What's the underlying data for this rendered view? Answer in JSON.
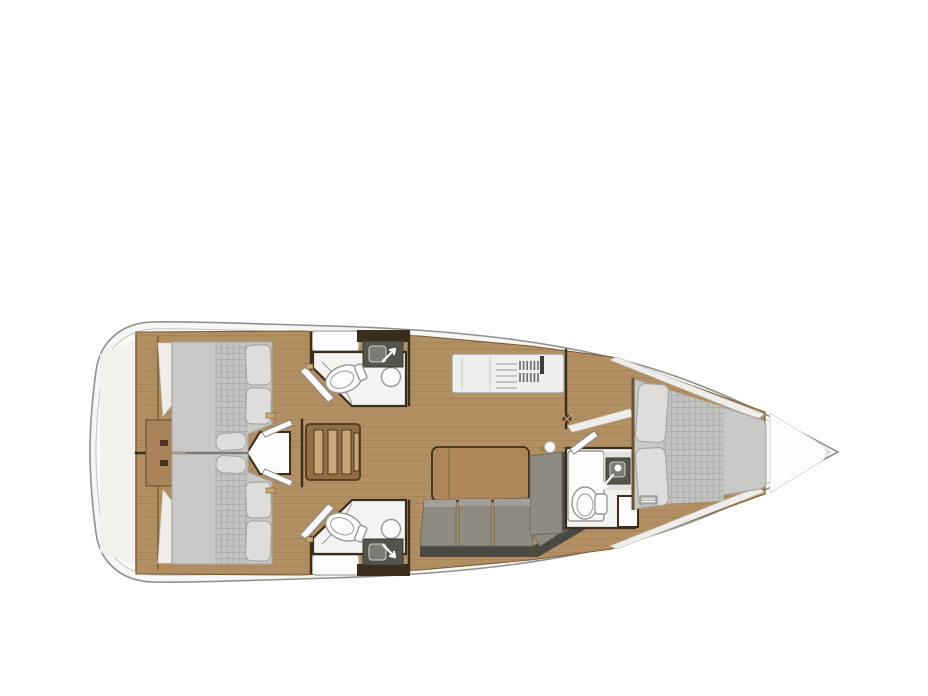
{
  "plan": {
    "type": "Sailing yacht interior floor plan, top view, bow to the right",
    "areas": [
      {
        "id": "stern-platform",
        "desc": "stern transom platform"
      },
      {
        "id": "aft-cabin-port",
        "desc": "aft double cabin, top"
      },
      {
        "id": "aft-cabin-starboard",
        "desc": "aft double cabin, bottom"
      },
      {
        "id": "aft-head-port",
        "desc": "aft head with toilet, sink and shower, top"
      },
      {
        "id": "aft-head-starboard",
        "desc": "aft head with toilet, sink and shower, bottom"
      },
      {
        "id": "companionway",
        "desc": "companionway steps on centerline"
      },
      {
        "id": "galley",
        "desc": "galley counter with stove and drainer"
      },
      {
        "id": "salon",
        "desc": "salon with table and L-shaped sofa"
      },
      {
        "id": "forward-head",
        "desc": "forward head with toilet and sink"
      },
      {
        "id": "forward-cabin",
        "desc": "forward V-berth double cabin"
      },
      {
        "id": "bow-locker",
        "desc": "bow anchor locker"
      }
    ]
  },
  "colors": {
    "background": "#ffffff",
    "hull_line": "#8f8f8d",
    "hull_inner_line": "#c6c6c4",
    "hull_fill": "#f6f6f4",
    "deck_fill": "#fbfbfa",
    "stern_tint": "#f2f1ec",
    "wood": "#b28e63",
    "wood_line": "#9c7a52",
    "wood_dark": "#a9845a",
    "wall": "#3b2d1c",
    "trim_brown": "#7a5c38",
    "mattress": "#c9c9c7",
    "mattress_line": "#a6a6a4",
    "plaid_base": "#c2c2c0",
    "plaid_line": "#b0b0ae",
    "pillow": "#dedddb",
    "pillow_line": "#a9a8a6",
    "white_area": "#efeeea",
    "bath_floor": "#f3f3f2",
    "fixture": "#fdfdfd",
    "fixture_line": "#979795",
    "counter_dark": "#53554d",
    "sink_inner": "#7b7d74",
    "galley_counter": "#eff0ee",
    "galley_line": "#b7b7b5",
    "grill": "#6f6f6d",
    "sofa": "#8e8b81",
    "sofa_hi": "#a3a099",
    "sofa_dark": "#4c4942",
    "sofa_edge": "#6e6b63",
    "table": "#ad8759",
    "table_line": "#3f2f1d",
    "steps_base": "#8f6d45",
    "steps_light": "#c9a878",
    "steps_dark": "#54351d"
  }
}
